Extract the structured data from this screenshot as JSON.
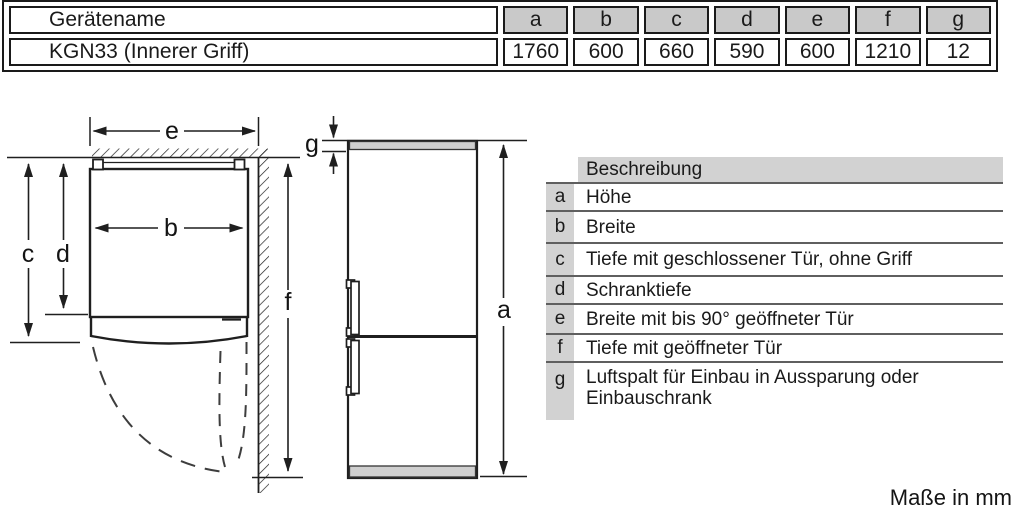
{
  "spec_table": {
    "header": {
      "name": "Gerätename",
      "dims": [
        "a",
        "b",
        "c",
        "d",
        "e",
        "f",
        "g"
      ]
    },
    "row": {
      "name": "KGN33 (Innerer Griff)",
      "values": [
        "1760",
        "600",
        "660",
        "590",
        "600",
        "1210",
        "12"
      ]
    }
  },
  "legend": {
    "header": "Beschreibung",
    "rows": [
      {
        "key": "a",
        "desc": "Höhe"
      },
      {
        "key": "b",
        "desc": "Breite"
      },
      {
        "key": "c",
        "desc": "Tiefe mit geschlossener Tür, ohne Griff"
      },
      {
        "key": "d",
        "desc": "Schranktiefe"
      },
      {
        "key": "e",
        "desc": "Breite mit bis 90° geöffneter Tür"
      },
      {
        "key": "f",
        "desc": "Tiefe mit geöffneter Tür"
      },
      {
        "key": "g",
        "desc": "Luftspalt für Einbau in Aussparung oder Einbauschrank"
      }
    ]
  },
  "diagram": {
    "labels": {
      "a": "a",
      "b": "b",
      "c": "c",
      "d": "d",
      "e": "e",
      "f": "f",
      "g": "g"
    }
  },
  "footer": {
    "units_label": "Maße in mm"
  },
  "colors": {
    "table_header_fill": "#c9c9c9",
    "legend_fill": "#d2d2d2",
    "line": "#1f1f1f",
    "appliance_fill": "#cfcfcf"
  }
}
